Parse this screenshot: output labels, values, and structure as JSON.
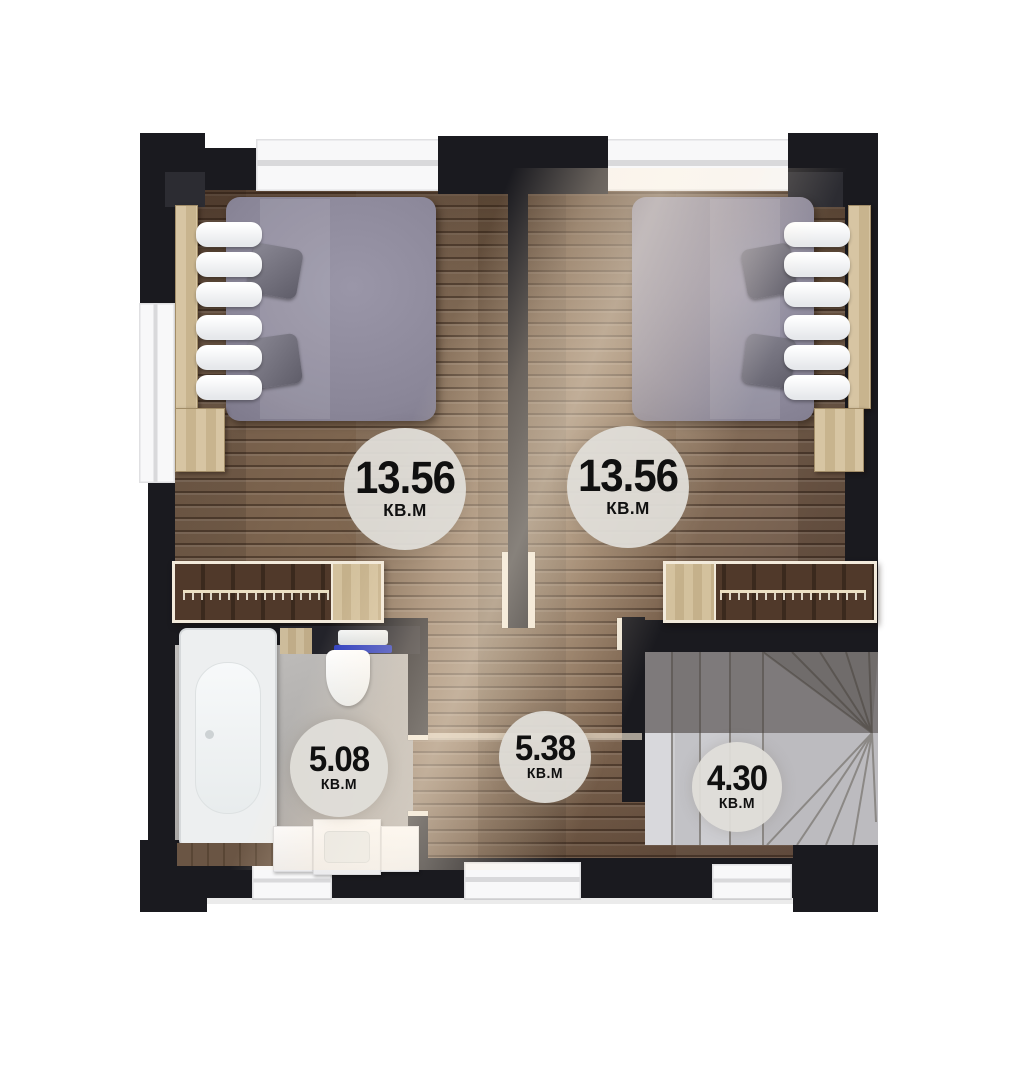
{
  "plan": {
    "rooms": {
      "bedroom_left": {
        "label_area": "13.56",
        "label_unit": "КВ.М"
      },
      "bedroom_right": {
        "label_area": "13.56",
        "label_unit": "КВ.М"
      },
      "bathroom": {
        "label_area": "5.08",
        "label_unit": "КВ.М"
      },
      "hallway": {
        "label_area": "5.38",
        "label_unit": "КВ.М"
      },
      "staircase": {
        "label_area": "4.30",
        "label_unit": "КВ.М"
      }
    },
    "colors": {
      "wall": "#1a1a1f",
      "wood_floor": "#79604c",
      "bathroom_floor": "#b2b0ae",
      "stairs": "#bcbbbf",
      "bed": "#8a8698",
      "badge_background": "#e0ded9",
      "badge_text": "#101010",
      "towel_blue": "#2b3cc0",
      "window": "#f8f8f9",
      "light_wood_furniture": "#d0bd98"
    }
  }
}
